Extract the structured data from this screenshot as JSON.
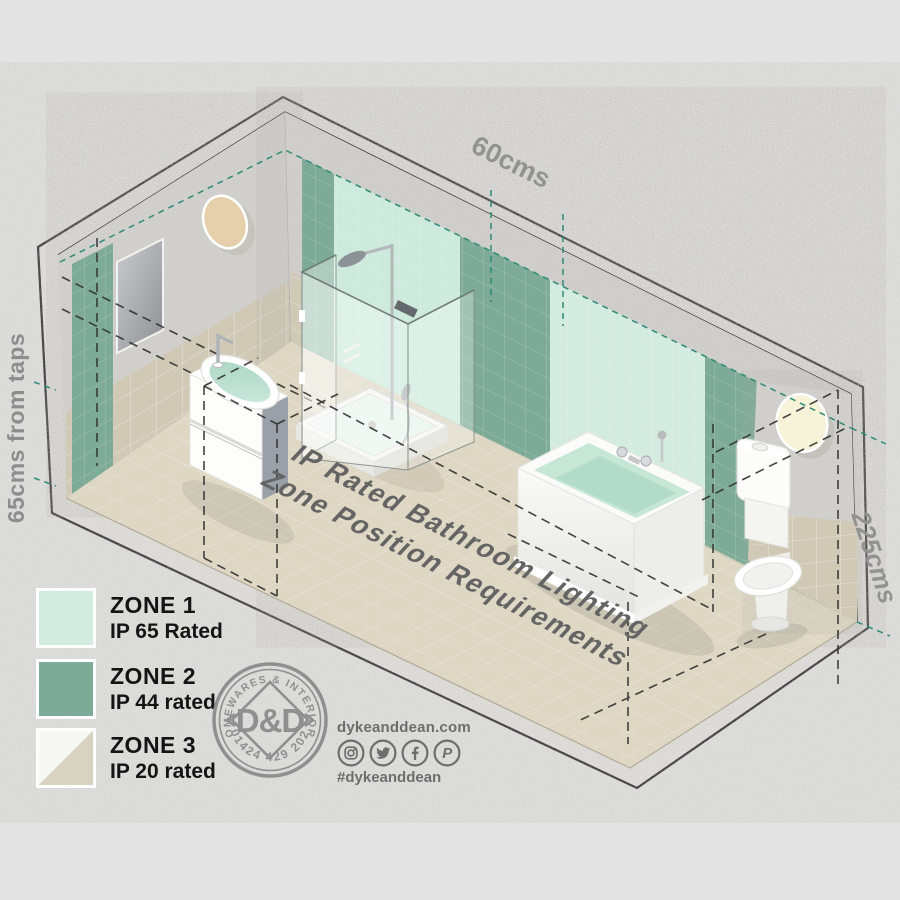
{
  "canvas": {
    "width": 900,
    "height": 900,
    "background": "#e4e4e4"
  },
  "diagram": {
    "floor_title": {
      "line1": "IP Rated Bathroom Lighting",
      "line2": "Zone Position Requirements"
    },
    "dimension_labels": {
      "top": "60cms",
      "left": "65cms from taps",
      "right": "225cms"
    }
  },
  "legend": {
    "items": [
      {
        "zone_label": "ZONE 1",
        "rating_label": "IP 65 Rated",
        "swatch_color": "#d2ecdf",
        "swatch_style": "solid"
      },
      {
        "zone_label": "ZONE 2",
        "rating_label": "IP 44 rated",
        "swatch_color": "#7dab97",
        "swatch_style": "solid"
      },
      {
        "zone_label": "ZONE 3",
        "rating_label": "IP 20 rated",
        "swatch_color": "#f7f7f3",
        "swatch_color_secondary": "#d8d2c0",
        "swatch_style": "diagonal-split"
      }
    ]
  },
  "branding": {
    "stamp": {
      "arc_top": "HOMEWARES & INTERIORS",
      "arc_bottom": "01424 429 202",
      "monogram": "D&D"
    },
    "website": "dykeanddean.com",
    "hashtag": "#dykeanddean",
    "social_icons": [
      {
        "name": "instagram-icon"
      },
      {
        "name": "twitter-icon"
      },
      {
        "name": "facebook-icon"
      },
      {
        "name": "pinterest-icon"
      }
    ]
  },
  "colors": {
    "zone1_mint": "#d2ecdf",
    "zone2_green": "#7dab97",
    "zone3_beige": "#d8d2c0",
    "teal_dash": "#2e8a78",
    "wall_concrete": "#d6d5d1",
    "wall_tile": "#cfc9b6",
    "floor": "#ddd7c3",
    "dimension_text": "#8f8f8f",
    "title_text": "#646464"
  }
}
